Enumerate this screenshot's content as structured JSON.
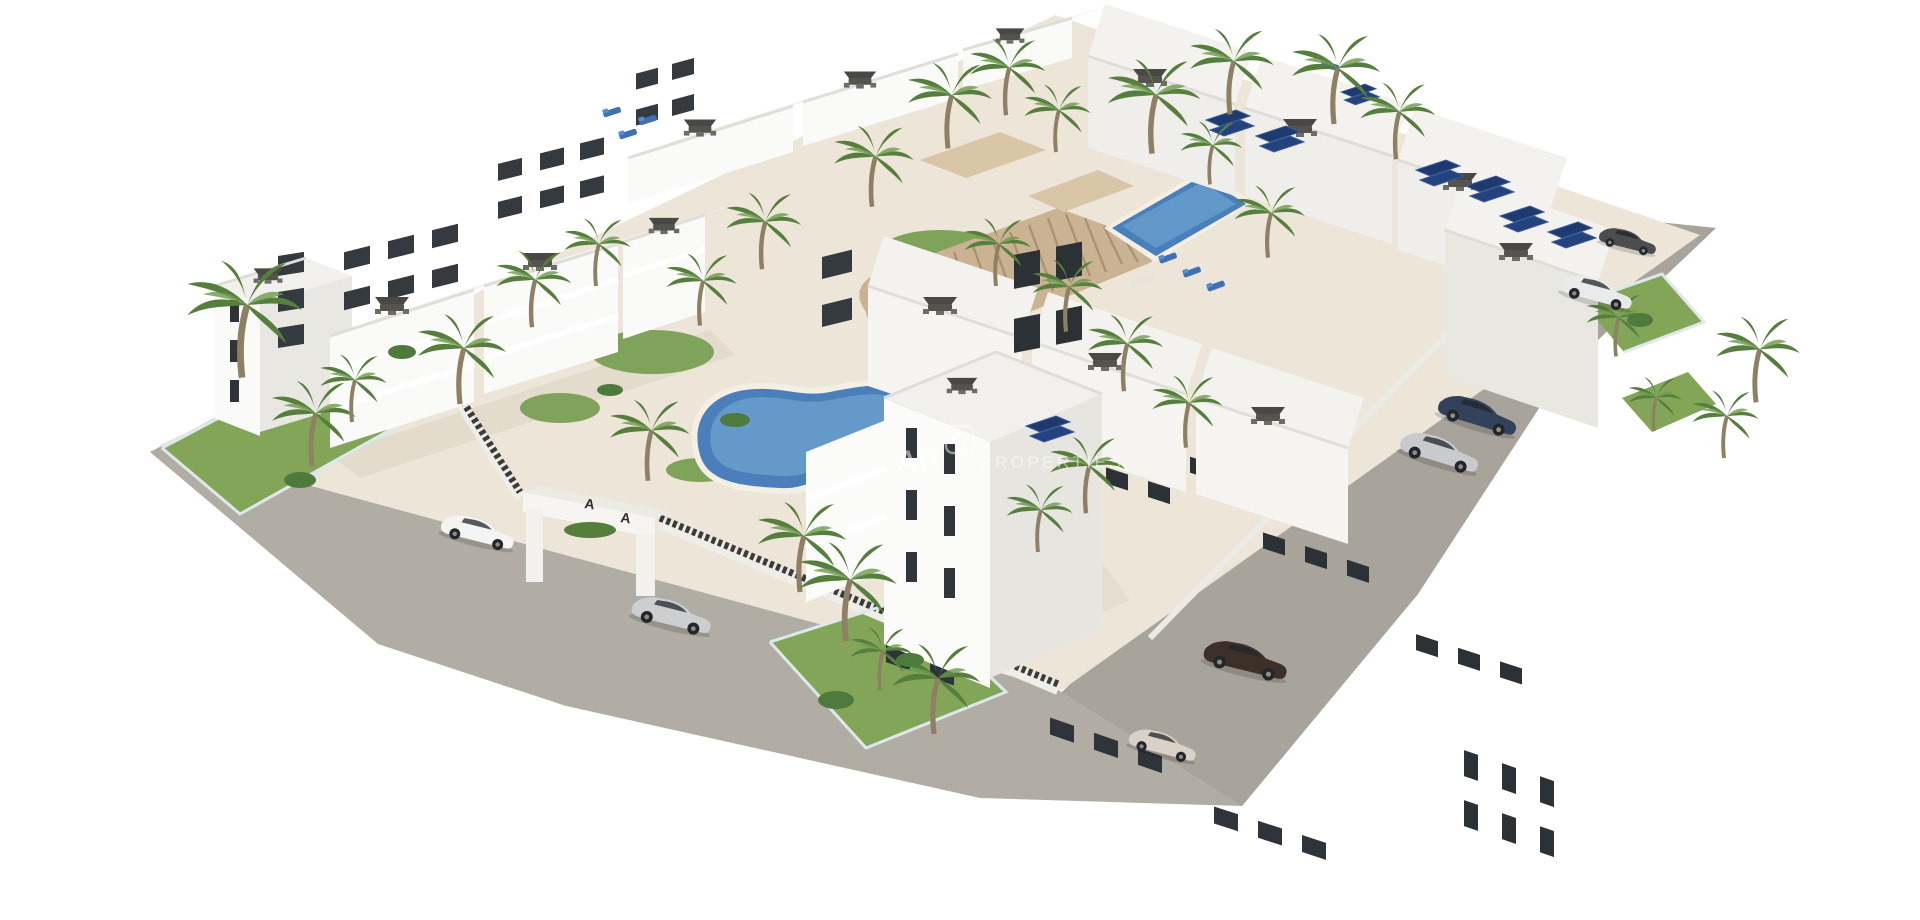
{
  "scene": {
    "type": "aerial 3d architectural render",
    "subject": "White Mediterranean apartment complex with courtyard pools, palm trees, rooftop terraces, solar panels, perimeter road and parked cars"
  },
  "watermark": {
    "logo_text": "AB",
    "brand_text": "PROPERTIES",
    "icon": "house-icon"
  },
  "entrance_gate": {
    "mark_left": "A",
    "mark_right": "A"
  },
  "colors": {
    "background": "#ffffff",
    "road": "#b2ada4",
    "courtyard": "#ece5d8",
    "lawn": "#82a558",
    "palm_frond": "#567f3e",
    "palm_trunk": "#8f7f63",
    "building_white": "#fafaf8",
    "building_shade": "#e3e1dc",
    "building_dark_side": "#cfcdc8",
    "window": "#2f343a",
    "pool_water": "#4a7fbc",
    "pool_rim": "#a8d0e4",
    "pool_deck": "#f4efe4",
    "solar_panel": "#1e3a6e",
    "wood_deck": "#c9b392",
    "wood_slat": "#ab9271",
    "fence_dark": "#3b3b3b",
    "glass_fence": "#dce9ec"
  },
  "inventory": {
    "pools": [
      "kidney-ground-pool",
      "rect-courtyard-pool"
    ],
    "cars": [
      {
        "color_name": "white suv",
        "location": "west entrance road"
      },
      {
        "color_name": "silver coupe",
        "location": "south entrance road"
      },
      {
        "color_name": "dark blue sedan",
        "location": "east road"
      },
      {
        "color_name": "silver sedan",
        "location": "east road"
      },
      {
        "color_name": "dark grey compact",
        "location": "north-east road"
      },
      {
        "color_name": "white suv",
        "location": "north-east road"
      },
      {
        "color_name": "dark brown suv",
        "location": "south road"
      },
      {
        "color_name": "beige hatchback",
        "location": "south road"
      }
    ]
  }
}
